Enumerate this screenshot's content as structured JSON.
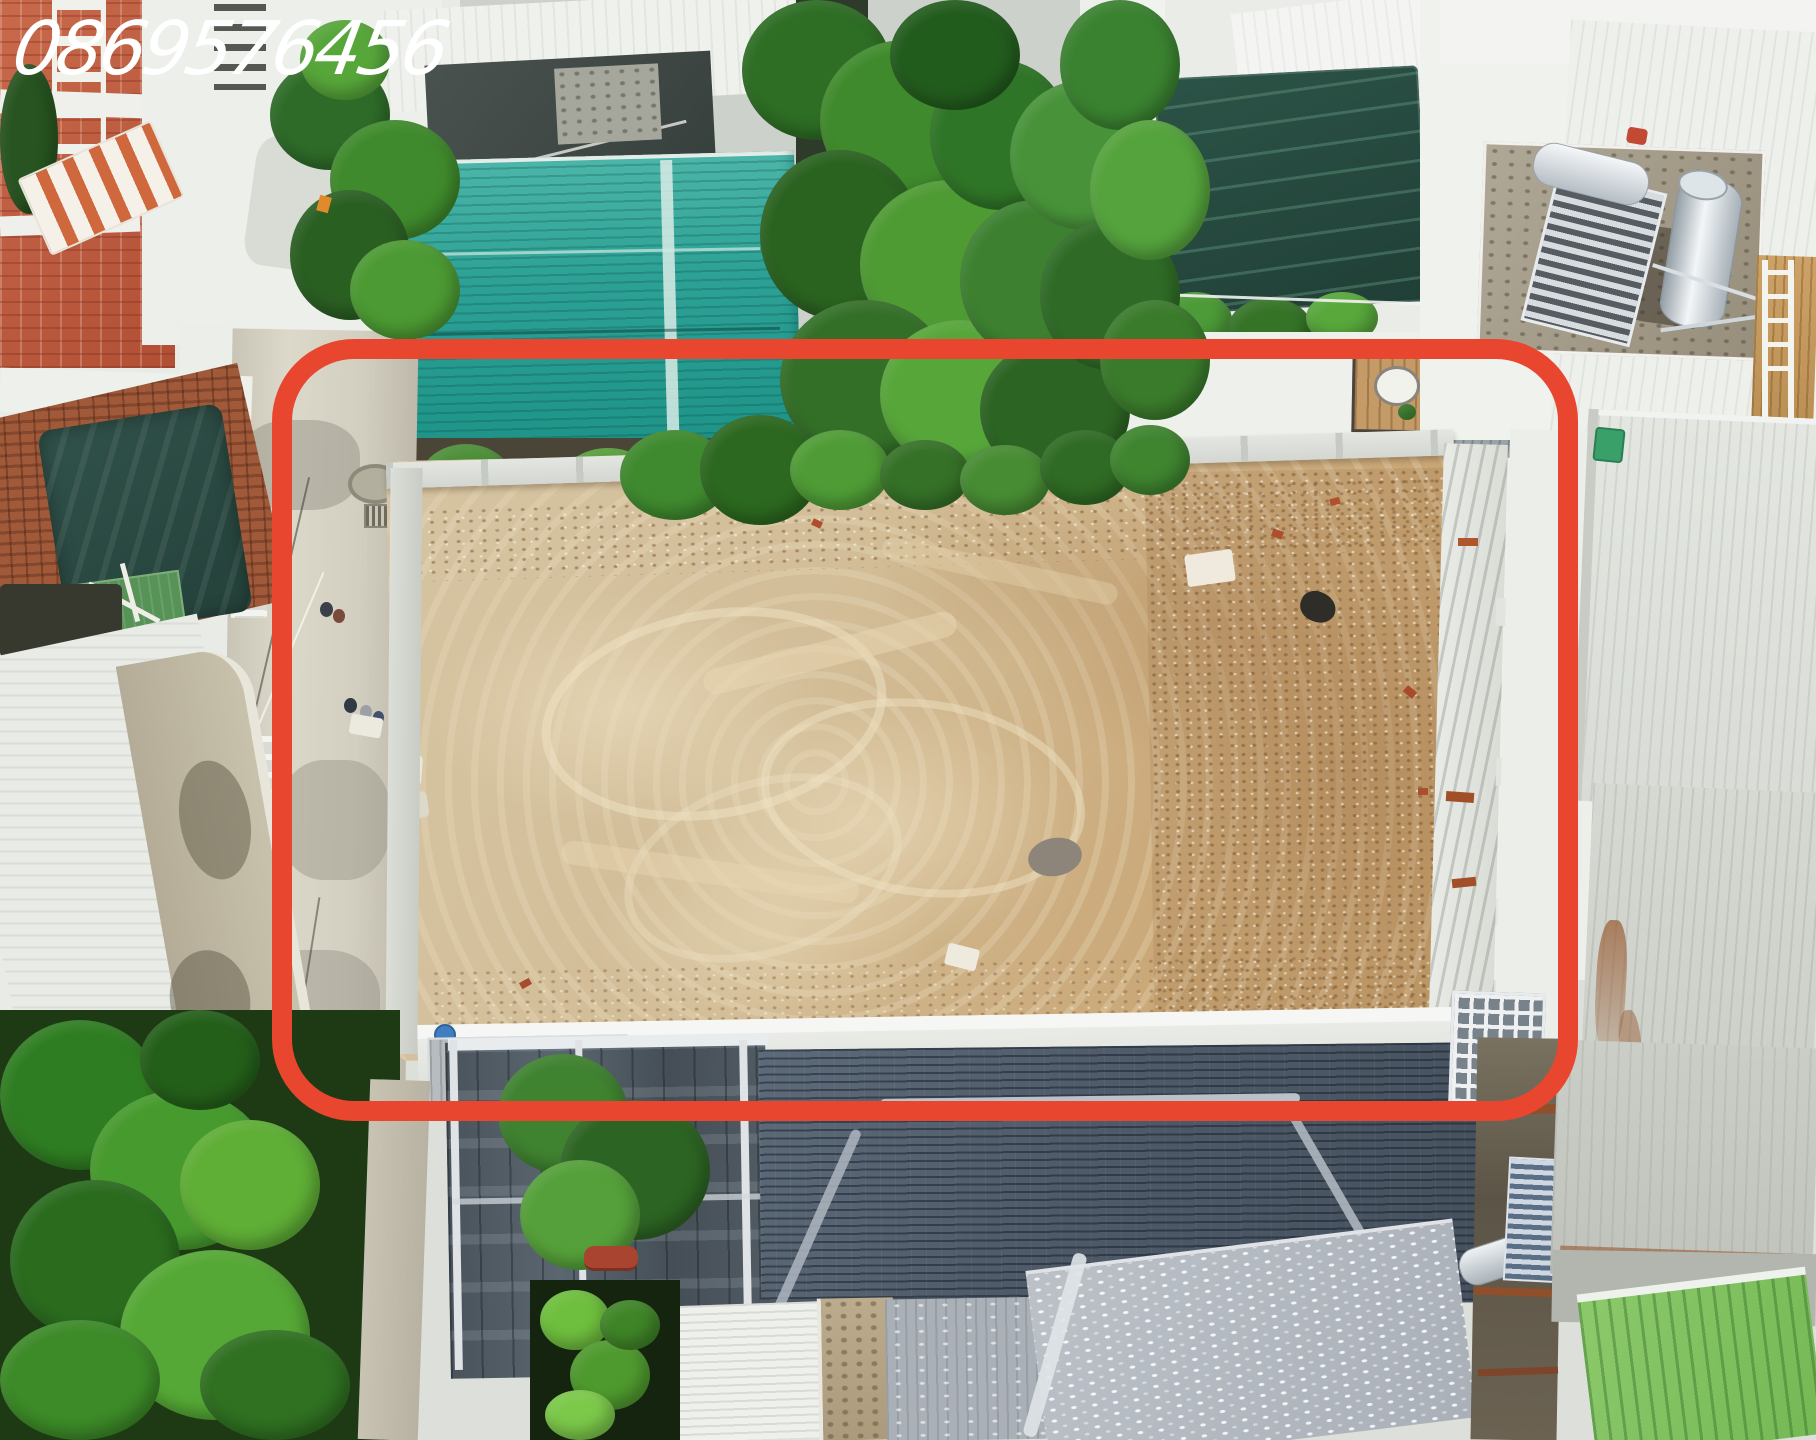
{
  "scene": {
    "kind": "aerial-drone-photo",
    "description": "Top-down drone photograph of a cleared sandy land plot for sale, outlined with a red rounded rectangle, in a dense residential neighborhood with corrugated metal roofs, a dark slate hip roof, palm and banana trees, rooftop solar water heaters and a concrete alley on the left.",
    "watermark": {
      "phone": "0869576456",
      "color": "#ffffff",
      "position": "top-left",
      "style": "white italic digits"
    },
    "highlight": {
      "shape": "rounded-rectangle",
      "stroke_color": "#e8462e",
      "stroke_width_px": 20,
      "corner_radius_px": 82,
      "left_px": 272,
      "top_px": 339,
      "width_px": 1306,
      "height_px": 782
    },
    "palette": {
      "dirt_sand": "#d3bf9c",
      "dirt_light": "#ecdfc2",
      "dirt_shadow": "#bfa47e",
      "teal_roof": "#2da195",
      "slate_roof": "#4e5a68",
      "white_roof": "#eff1ed",
      "pale_roof": "#dde0da",
      "green_roof": "#82c263",
      "shade_mesh_green": "#27493e",
      "foliage_green": "#3f8a2c",
      "banana_green": "#479a2e",
      "brick_red": "#c05f43",
      "terracotta_roof": "#9c5a3c",
      "concrete_road": "#d4d0c2",
      "carport_gray": "#4a535b",
      "rust": "#9a6038"
    },
    "features": [
      "vacant dirt plot outlined in red",
      "red rounded-rectangle highlight",
      "white phone-number watermark",
      "concrete alley with pedestrians and motorbike",
      "teal corrugated metal roof",
      "dark green rooftop shade net",
      "rooftop solar water heater and stainless tank",
      "old terracotta tile roof with green tarp",
      "white corrugated roofs",
      "dark slate hip roof",
      "dark gray carport structure",
      "banana and palm trees",
      "bright green corrugated roof",
      "gray dash-pattern tile roof"
    ]
  }
}
